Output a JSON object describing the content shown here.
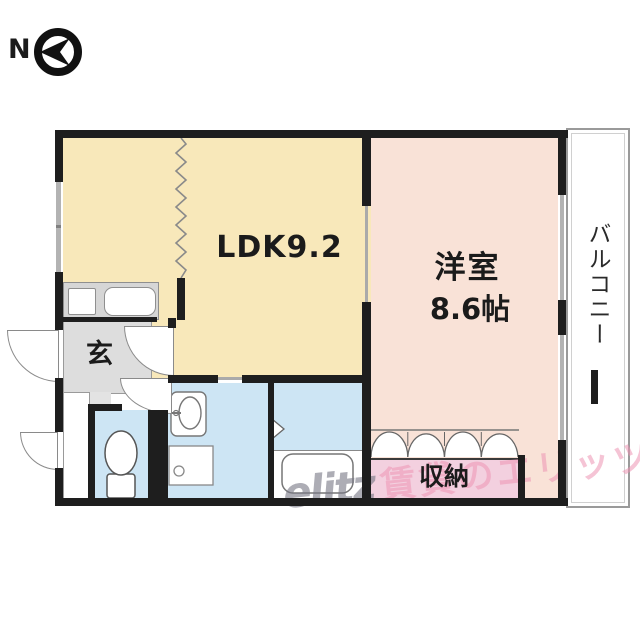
{
  "compass": {
    "north_label": "N"
  },
  "floor_plan": {
    "rooms": {
      "ldk": {
        "label": "LDK9.2"
      },
      "western_room": {
        "name": "洋室",
        "size": "8.6帖"
      },
      "balcony": {
        "label": "バルコニー"
      },
      "entrance": {
        "label": "玄"
      },
      "closet": {
        "label": "収納"
      }
    },
    "colors": {
      "ldk_fill": "#f8e8ba",
      "western_room_fill": "#f9e2d7",
      "closet_fill": "#f3d0df",
      "wet_area_fill": "#cde5f4",
      "entrance_fill": "#dddddd",
      "wall": "#1e1e1e",
      "window": "#b3b3b3",
      "watermark_pink": "#ec94b2",
      "watermark_gray": "#767684"
    }
  },
  "watermark": {
    "logo": "elitz",
    "text": "賃貸のエリッツ"
  }
}
